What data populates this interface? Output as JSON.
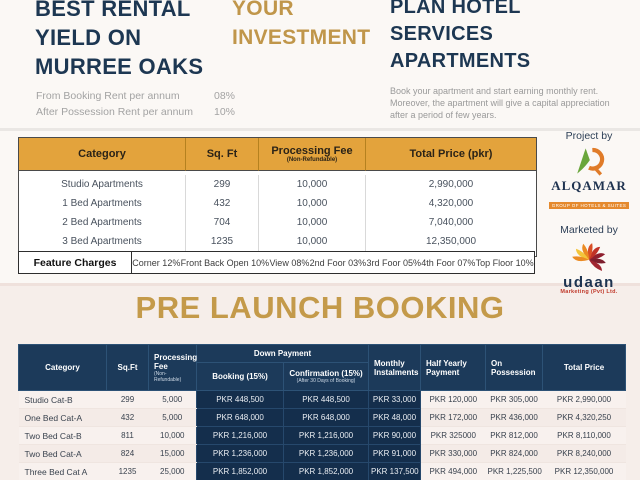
{
  "page": {
    "left_heading": [
      "BEST RENTAL",
      "YIELD ON",
      "MURREE OAKS"
    ],
    "left_sub": [
      {
        "label": "From Booking Rent per annum",
        "value": "08%"
      },
      {
        "label": "After Possession Rent per annum",
        "value": "10%"
      }
    ],
    "mid_heading": [
      "YOUR",
      "INVESTMENT"
    ],
    "right_heading": [
      "PLAN HOTEL",
      "SERVICES",
      "APARTMENTS"
    ],
    "right_paragraph": "Book your apartment and start earning monthly rent. Moreover, the apartment will give a capital appreciation after a period of few years.",
    "section_title": "PRE LAUNCH BOOKING"
  },
  "price_table": {
    "headers": {
      "category": "Category",
      "sqft": "Sq. Ft",
      "processing": "Processing Fee",
      "processing_sub": "(Non-Refundable)",
      "total": "Total Price (pkr)"
    },
    "rows": [
      {
        "category": "Studio Apartments",
        "sqft": "299",
        "processing": "10,000",
        "total": "2,990,000"
      },
      {
        "category": "1 Bed Apartments",
        "sqft": "432",
        "processing": "10,000",
        "total": "4,320,000"
      },
      {
        "category": "2 Bed Apartments",
        "sqft": "704",
        "processing": "10,000",
        "total": "7,040,000"
      },
      {
        "category": "3 Bed Apartments",
        "sqft": "1235",
        "processing": "10,000",
        "total": "12,350,000"
      }
    ]
  },
  "feature_charges": {
    "label": "Feature Charges",
    "items": [
      "Corner 12%",
      "Front Back Open 10%",
      "View 08%",
      "2nd Foor 03%",
      "3rd Foor 05%",
      "4th Foor 07%",
      "Top Floor 10%"
    ]
  },
  "branding": {
    "project_by": "Project by",
    "alqamar_name": "ALQAMAR",
    "alqamar_tagline": "GROUP OF HOTELS & SUITES",
    "marketed_by": "Marketed by",
    "udaan_name": "udaan",
    "udaan_sub": "Marketing (Pvt) Ltd."
  },
  "booking_table": {
    "headers": {
      "category": "Category",
      "sqft": "Sq.Ft",
      "processing": "Processing Fee",
      "processing_sub": "(Non-Refundable)",
      "down_payment": "Down Payment",
      "booking": "Booking (15%)",
      "confirmation": "Confirmation (15%)",
      "confirmation_sub": "(After 30 Days of Booking)",
      "monthly": "Monthly Instalments",
      "half_yearly": "Half Yearly Payment",
      "possession": "On Possession",
      "total": "Total Price"
    },
    "rows": [
      {
        "category": "Studio Cat-B",
        "sqft": "299",
        "processing": "5,000",
        "booking": "PKR 448,500",
        "confirmation": "PKR 448,500",
        "monthly": "PKR 33,000",
        "half_yearly": "PKR 120,000",
        "possession": "PKR 305,000",
        "total": "PKR 2,990,000"
      },
      {
        "category": "One Bed Cat-A",
        "sqft": "432",
        "processing": "5,000",
        "booking": "PKR 648,000",
        "confirmation": "PKR 648,000",
        "monthly": "PKR 48,000",
        "half_yearly": "PKR 172,000",
        "possession": "PKR 436,000",
        "total": "PKR 4,320,250"
      },
      {
        "category": "Two Bed Cat-B",
        "sqft": "811",
        "processing": "10,000",
        "booking": "PKR 1,216,000",
        "confirmation": "PKR 1,216,000",
        "monthly": "PKR 90,000",
        "half_yearly": "PKR 325000",
        "possession": "PKR 812,000",
        "total": "PKR 8,110,000"
      },
      {
        "category": "Two Bed Cat-A",
        "sqft": "824",
        "processing": "15,000",
        "booking": "PKR 1,236,000",
        "confirmation": "PKR 1,236,000",
        "monthly": "PKR 91,000",
        "half_yearly": "PKR 330,000",
        "possession": "PKR 824,000",
        "total": "PKR 8,240,000"
      },
      {
        "category": "Three Bed Cat A",
        "sqft": "1235",
        "processing": "25,000",
        "booking": "PKR 1,852,000",
        "confirmation": "PKR 1,852,000",
        "monthly": "PKR 137,500",
        "half_yearly": "PKR 494,000",
        "possession": "PKR 1,225,500",
        "total": "PKR 12,350,000"
      }
    ]
  },
  "colors": {
    "navy_heading": "#1d3752",
    "gold": "#c0964a",
    "table1_header": "#e3a33c",
    "table2_header_navy": "#1c3a5a",
    "table2_body_navy": "#142e4c",
    "light_row": "#f8f1ee"
  }
}
